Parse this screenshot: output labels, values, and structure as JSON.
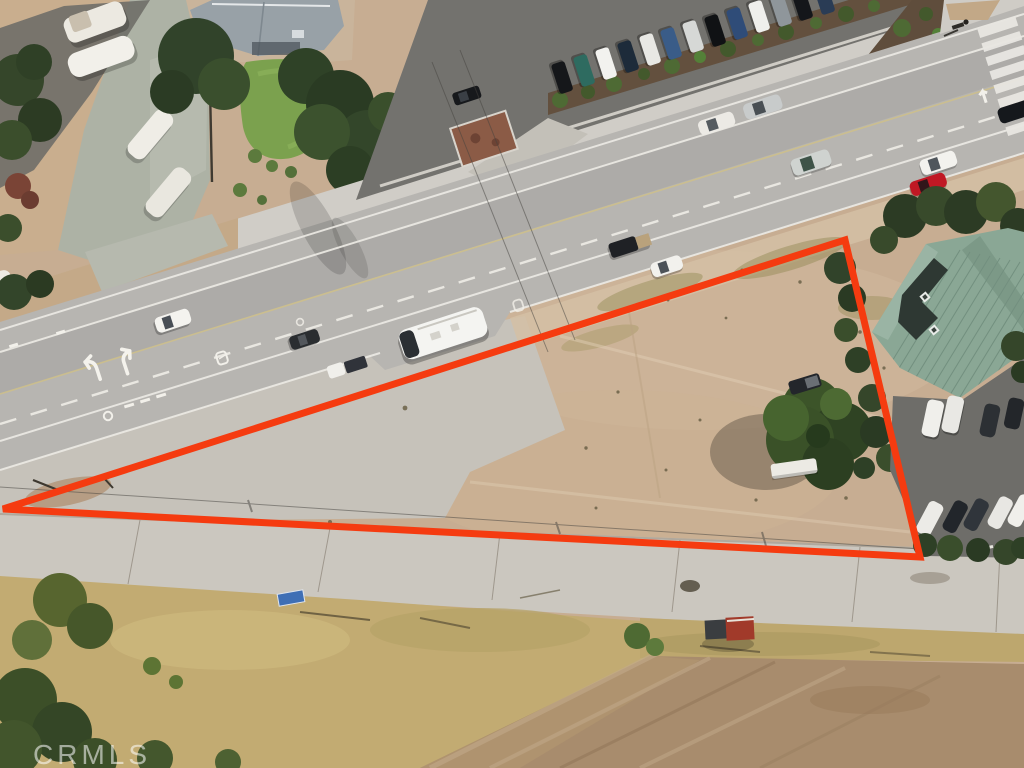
{
  "watermark": {
    "text": "CRMLS"
  },
  "boundary": {
    "color": "#f53b10"
  },
  "scene": {
    "description": "Aerial drone photo of a triangular vacant dirt lot outlined in red, bordered by a multi-lane road with traffic, an RV storage yard, parking lots and a green-roofed building"
  }
}
